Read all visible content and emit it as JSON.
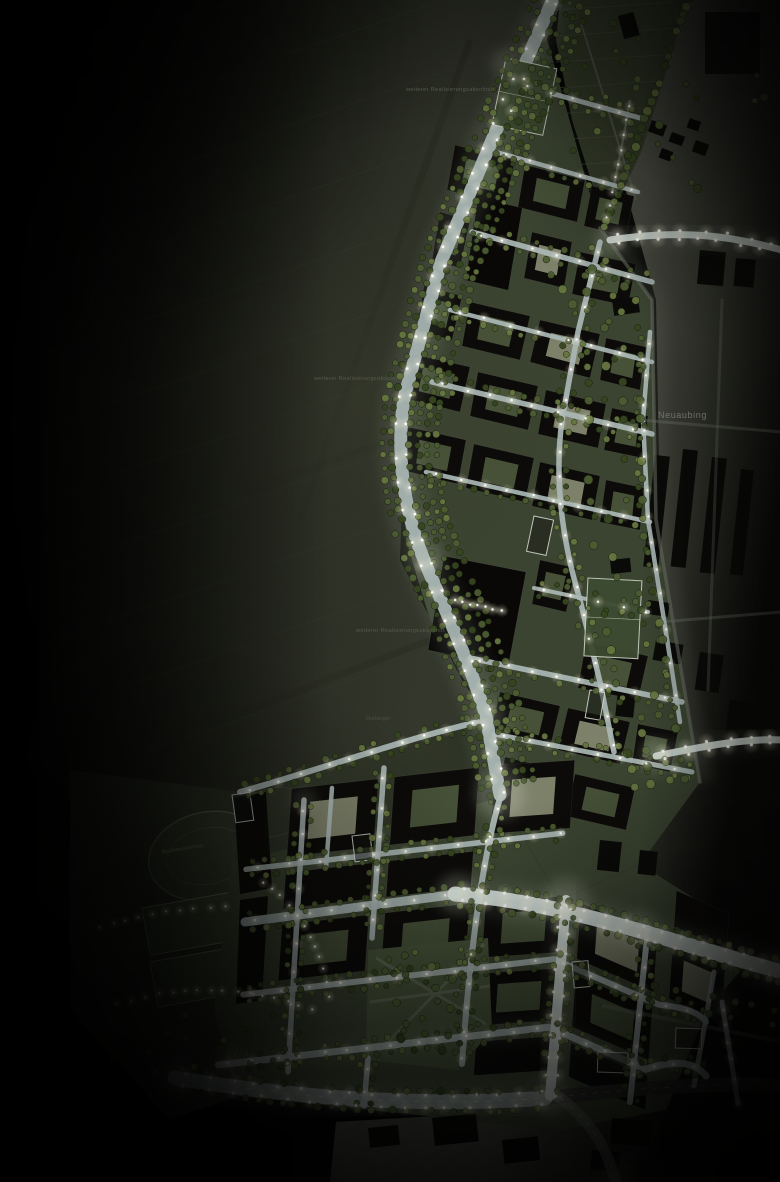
{
  "map": {
    "labels": {
      "district_east": "Neuaubing",
      "phase_note_top": "weiterer Realisierungsabschnitt",
      "phase_note_mid": "weiterer Realisierungsabschnitt",
      "phase_note_low": "weiterer Realisierungsabschnitt",
      "green_label": "Dorfanger",
      "sport_label": "Bezirkssportanlage"
    },
    "colors": {
      "background": "#020302",
      "haze": "#3c4030",
      "farmland_near": "#31342a",
      "farmland_far": "#0b0c09",
      "park": "#2b3124",
      "district_ground": "#3b4431",
      "courtyard_green": "#4a553b",
      "courtyard_light": "#84886f",
      "building_dark": "#0c0b09",
      "building_deep": "#090807",
      "existing_city": "#4a4c43",
      "existing_building": "#0a0a08",
      "road": "#aab7b5",
      "road_bright": "#dce8e4",
      "road_dim": "#6d7268",
      "road_dark": "#2e302b",
      "tree_dark": "#36461f",
      "tree_mid": "#4c5c31",
      "tree_light": "#66763f",
      "pitch_green": "#3d4b31",
      "light_white": "#ffffff",
      "light_warm": "#fff8dc"
    }
  }
}
